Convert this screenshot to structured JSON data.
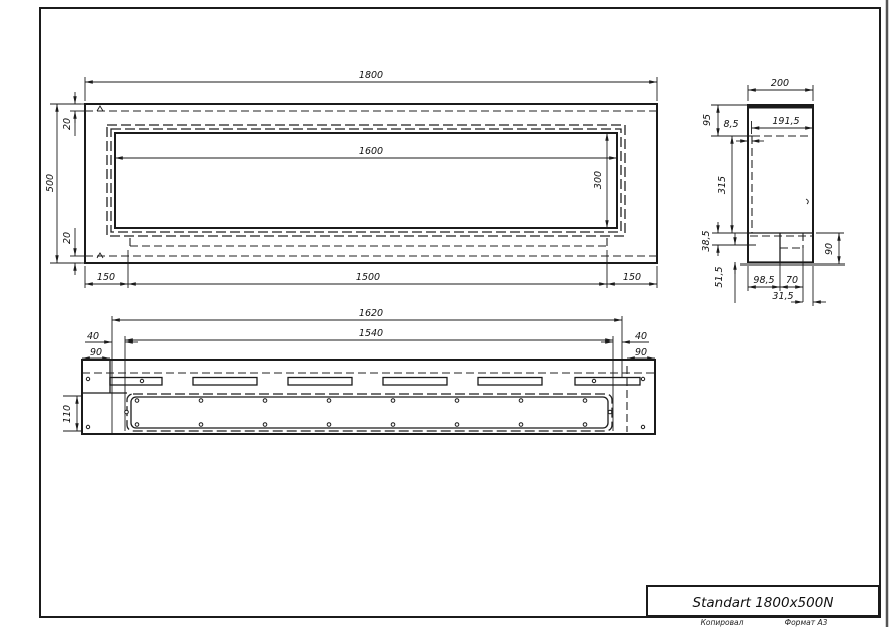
{
  "sheet": {
    "title": "Standart 1800x500N",
    "copied_label": "Копировал",
    "format_label": "Формат А3"
  },
  "colors": {
    "line": "#1b1b1b",
    "base_shadow": "#8a8a8a",
    "background": "#ffffff"
  },
  "front_view": {
    "dims": {
      "overall_width": "1800",
      "overall_height": "500",
      "top_wall": "20",
      "bottom_wall": "20",
      "opening_width": "1600",
      "opening_height": "300",
      "left_offset": "150",
      "bottom_span": "1500",
      "right_offset": "150"
    }
  },
  "side_view": {
    "dims": {
      "depth": "200",
      "inner_depth": "191,5",
      "top_section": "95",
      "lip": "8,5",
      "mid_height": "315",
      "step": "38,5",
      "base_front": "51,5",
      "base_height": "90",
      "base_depth": "98,5",
      "burner_offset": "70",
      "rear_gap": "31,5"
    }
  },
  "bottom_view": {
    "dims": {
      "slot_span": "1620",
      "channel_span": "1540",
      "left_gap": "40",
      "left_flange": "90",
      "right_gap": "40",
      "right_flange": "90",
      "channel_width": "110"
    }
  }
}
